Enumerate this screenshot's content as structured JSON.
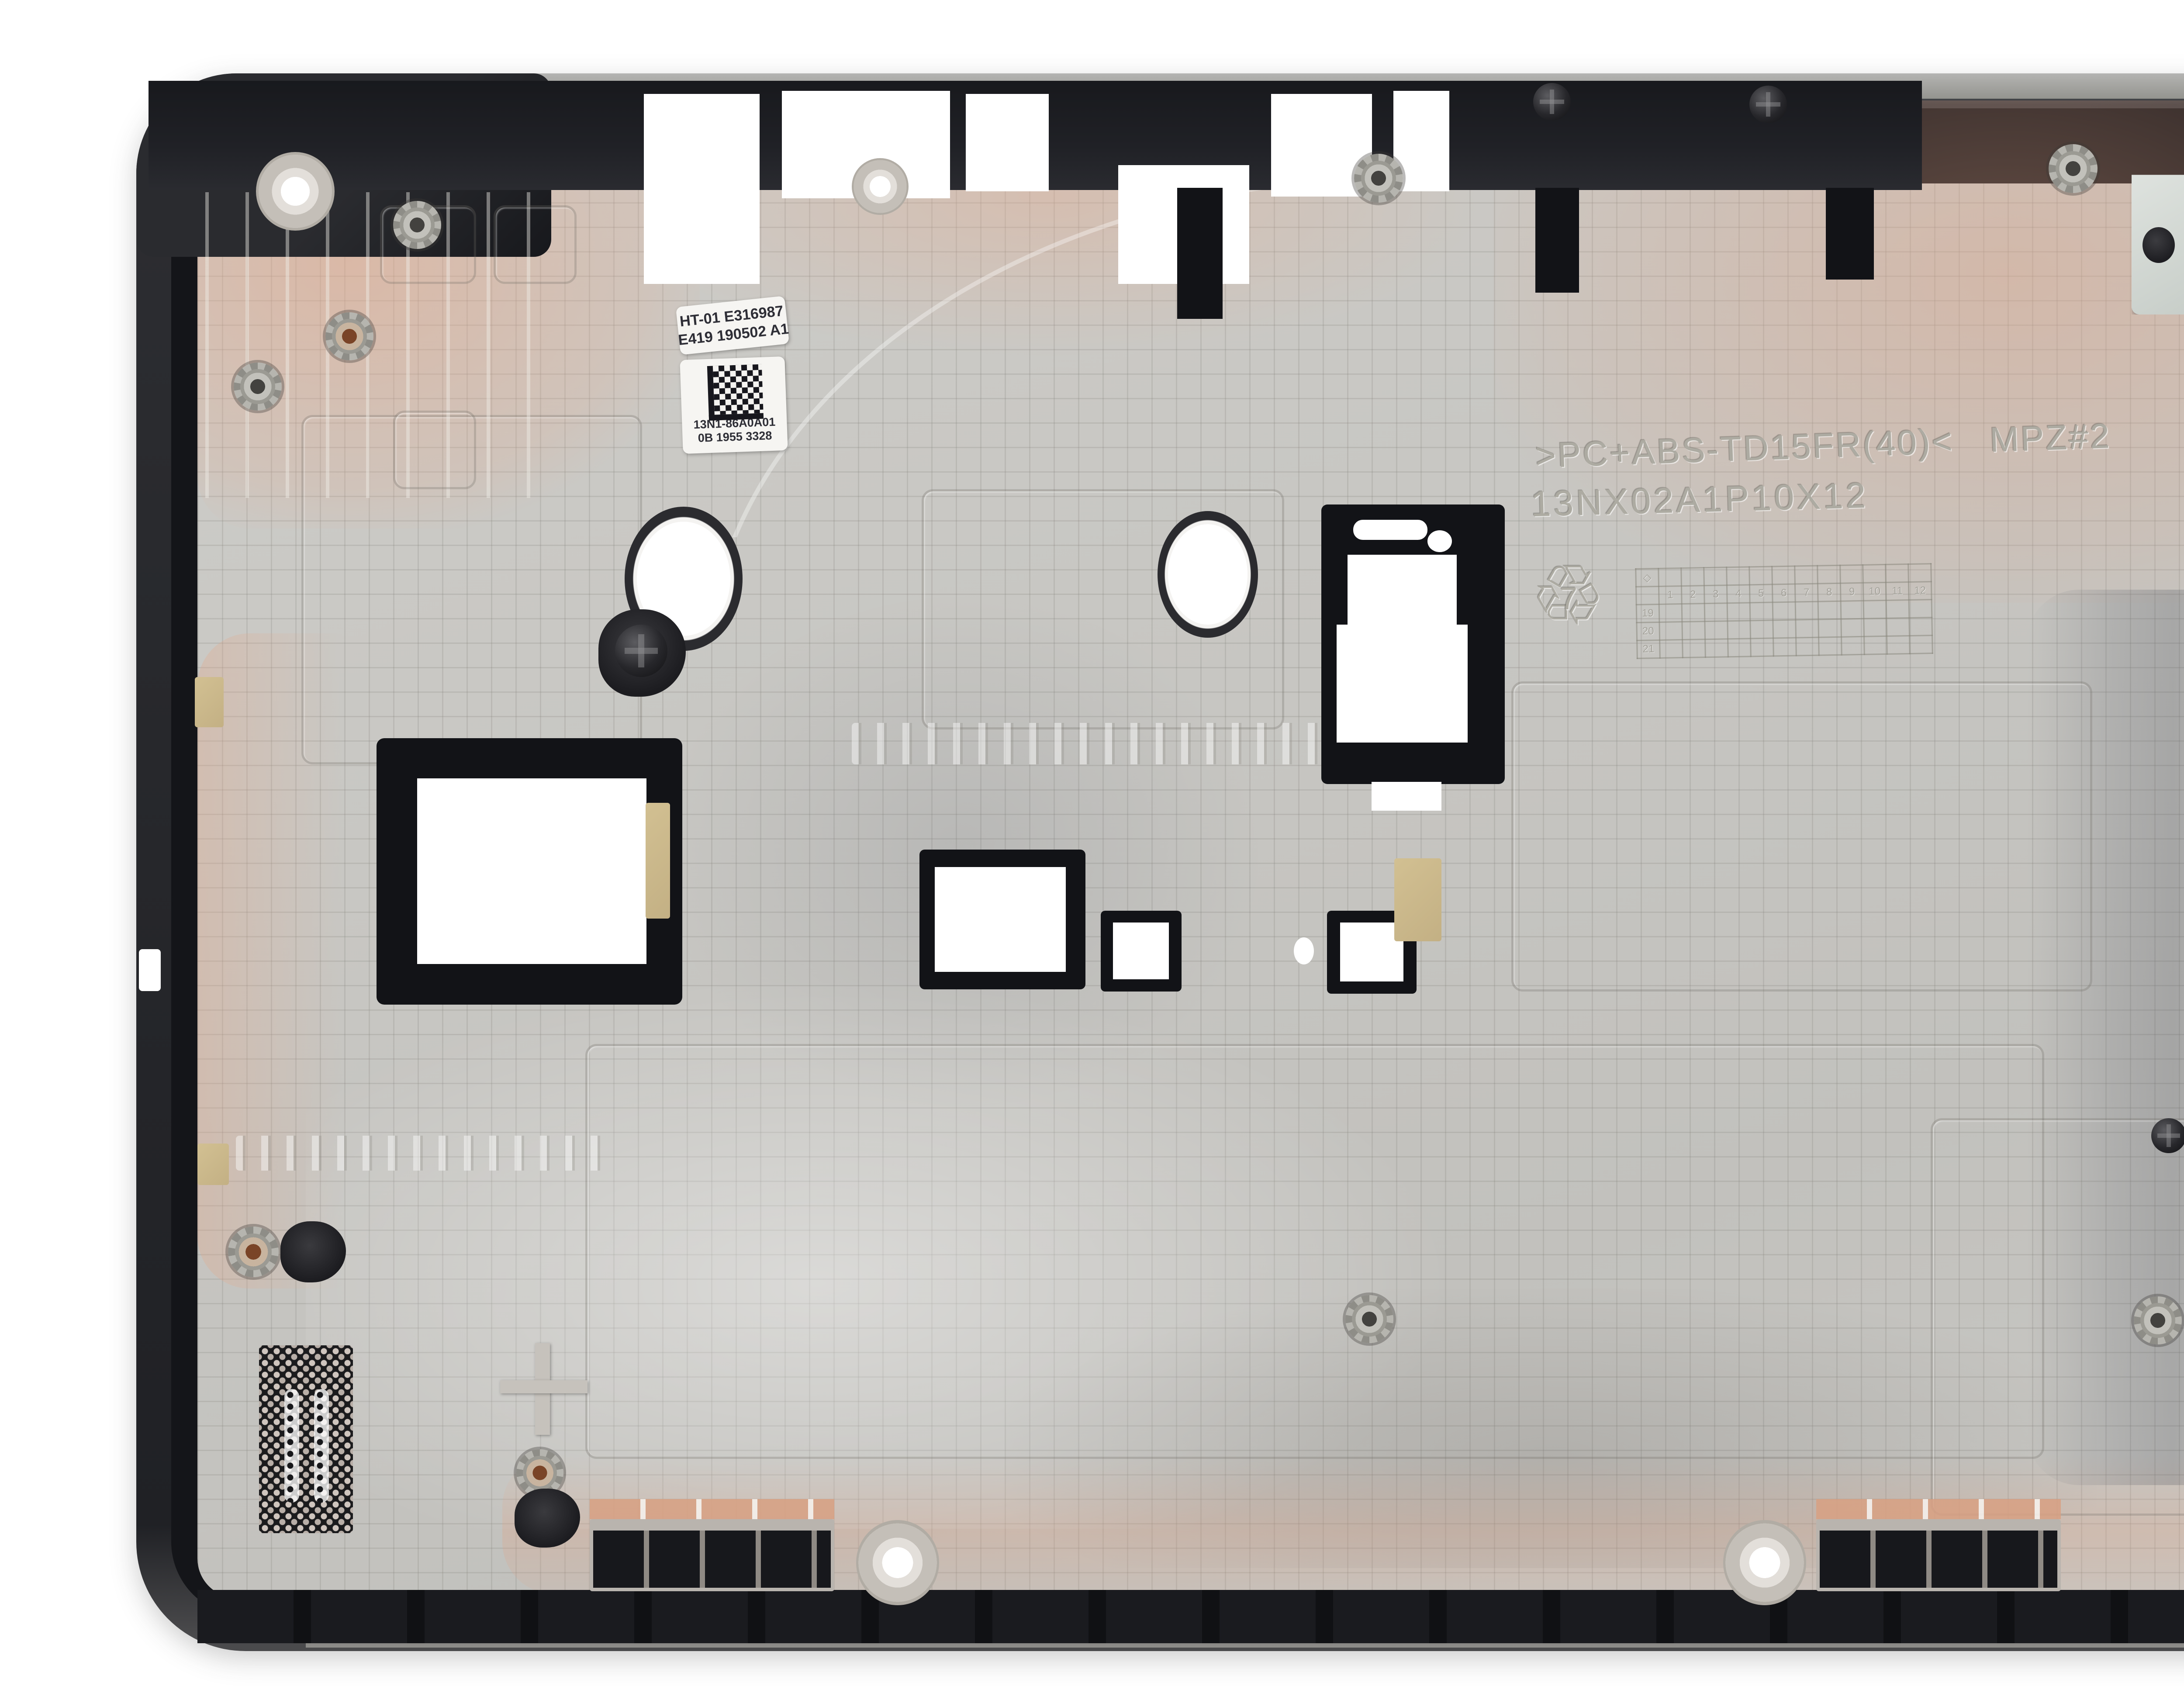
{
  "photo": {
    "subject": "laptop bottom case interior (replacement part photo)",
    "background_color": "#ffffff",
    "colors": {
      "face_gray": "#c7c6c2",
      "rim_dark": "#26272b",
      "channel_black": "#141519",
      "copper_tint": "#e2a486",
      "grille_black": "#1b1b1d",
      "bracket_metal": "#ccd2cd",
      "tape_tan": "#c9b68c",
      "sticker_white": "#f6f5f2"
    }
  },
  "stickers": {
    "esn_label": {
      "line1": "HT-01 E316987",
      "line2": "E419 190502 A1"
    },
    "barcode_label": {
      "icon": "datamatrix-barcode",
      "line1": "13N1-86A0A01",
      "line2": "0B 1955 3328"
    }
  },
  "molded_markings": {
    "material_code": ">PC+ABS-TD15FR(40)<",
    "mold_id": "MPZ#2",
    "part_number": "13NX02A1P10X12",
    "recycling_symbol": "♲",
    "resin_number": "7",
    "date_wheel": {
      "months": [
        "1",
        "2",
        "3",
        "4",
        "5",
        "6",
        "7",
        "8",
        "9",
        "10",
        "11",
        "12"
      ],
      "years": [
        "19",
        "20",
        "21"
      ]
    }
  },
  "watermark": {
    "logo": "AGI",
    "caption": "A s s e t G e n i e   I n c o r p o r a t e d"
  }
}
